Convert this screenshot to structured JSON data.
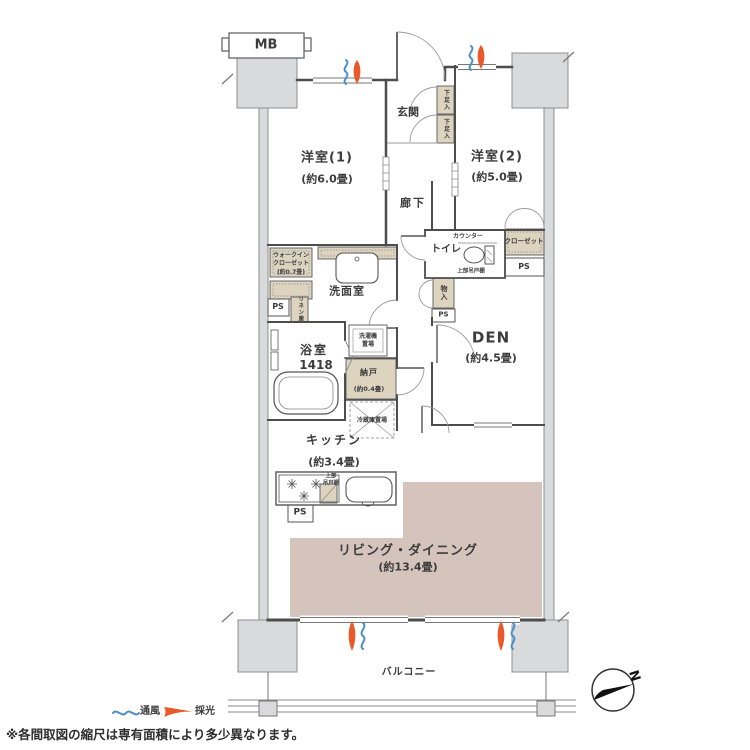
{
  "colors": {
    "wall": "#4d4d4d",
    "pillar_gray": "#d9dadb",
    "cabinet_beige": "#ddd4c0",
    "living_dining_floor": "#d5c4bc",
    "ventilation_blue": "#4b8fc9",
    "daylight_orange": "#e85a2a"
  },
  "compass": {
    "north": "N"
  },
  "legend": {
    "ventilation": "通風",
    "daylight": "採光"
  },
  "footnote": "※各間取図の縮尺は専有面積により多少異なります。",
  "rooms": {
    "mb": "MB",
    "western1": {
      "name": "洋室(1)",
      "area": "(約6.0畳)"
    },
    "western2": {
      "name": "洋室(2)",
      "area": "(約5.0畳)"
    },
    "entrance": "玄関",
    "shoe_cabinet_upper": "下足入",
    "shoe_cabinet_lower": "下足入",
    "hallway": "廊下",
    "toilet": "トイレ",
    "toilet_counter": "カウンター",
    "toilet_upper_cabinet": "上部吊戸棚",
    "closet": "クローゼット",
    "ps_closet": "PS",
    "storage": "物入",
    "ps_storage": "PS",
    "den": {
      "name": "DEN",
      "area": "(約4.5畳)"
    },
    "walk_in_closet": {
      "line1": "ウォークイン",
      "line2": "クローゼット",
      "line3": "(約0.7畳)"
    },
    "washroom": "洗面室",
    "ps_washroom": "PS",
    "linen": "リネン庫",
    "bathroom": {
      "name": "浴室",
      "size": "1418"
    },
    "washer": {
      "line1": "洗濯機",
      "line2": "置場"
    },
    "storeroom": {
      "name": "納戸",
      "area": "(約0.4畳)"
    },
    "fridge": "冷蔵庫置場",
    "kitchen": {
      "name": "キッチン",
      "area": "(約3.4畳)"
    },
    "kitchen_upper_cabinet": {
      "line1": "上部",
      "line2": "吊戸棚"
    },
    "ps_kitchen": "PS",
    "living_dining": {
      "name": "リビング・ダイニング",
      "area": "(約13.4畳)"
    },
    "balcony": "バルコニー"
  }
}
